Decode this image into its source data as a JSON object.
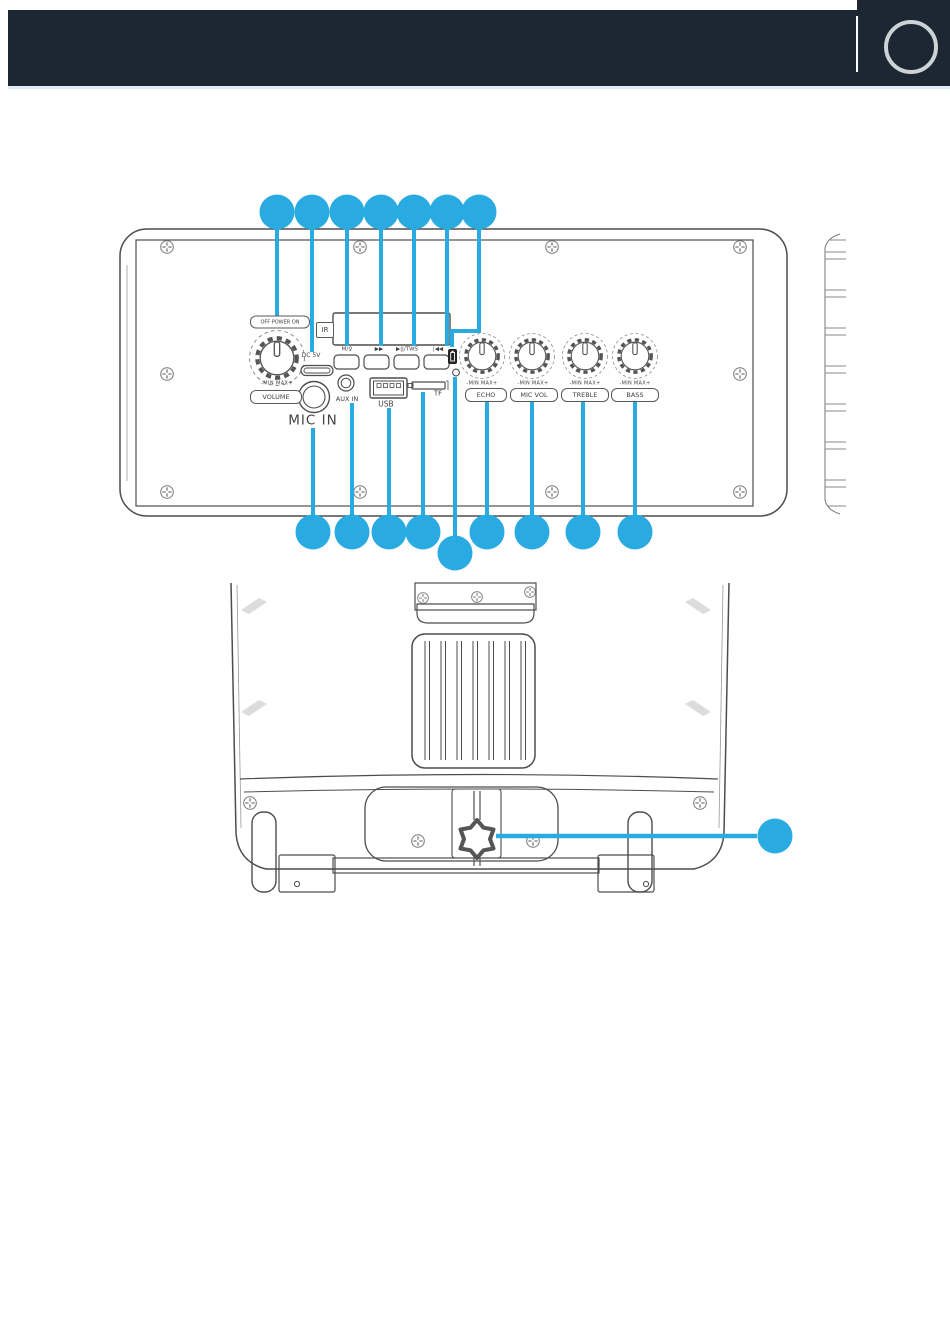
{
  "colors": {
    "callout_blue": "#29ABE2",
    "header_bg": "#1C2733",
    "line_gray": "#4D4D4D"
  },
  "header": {
    "logo_icon": "circle-outline"
  },
  "control_panel": {
    "power_switch_label": "OFF POWER ON",
    "volume_knob": {
      "range": "-MIN MAX+",
      "label": "VOLUME"
    },
    "dc_port_label": "DC 5V",
    "mic_jack_label": "MIC IN",
    "ir_sensor_label": "IR",
    "aux_jack_label": "AUX IN",
    "usb_port_label": "USB",
    "tf_slot_label": "TF",
    "buttons": [
      {
        "label": "M/♀"
      },
      {
        "label": "▶▶"
      },
      {
        "label": "▶||/TWS"
      },
      {
        "label": "|◀◀"
      }
    ],
    "knobs": [
      {
        "label": "ECHO",
        "range": "-MIN MAX+"
      },
      {
        "label": "MIC VOL",
        "range": "-MIN MAX+"
      },
      {
        "label": "TREBLE",
        "range": "-MIN MAX+"
      },
      {
        "label": "BASS",
        "range": "-MIN MAX+"
      }
    ]
  },
  "callouts": {
    "top_row_count": 7,
    "bottom_row_count": 9,
    "rear_view_count": 1
  }
}
